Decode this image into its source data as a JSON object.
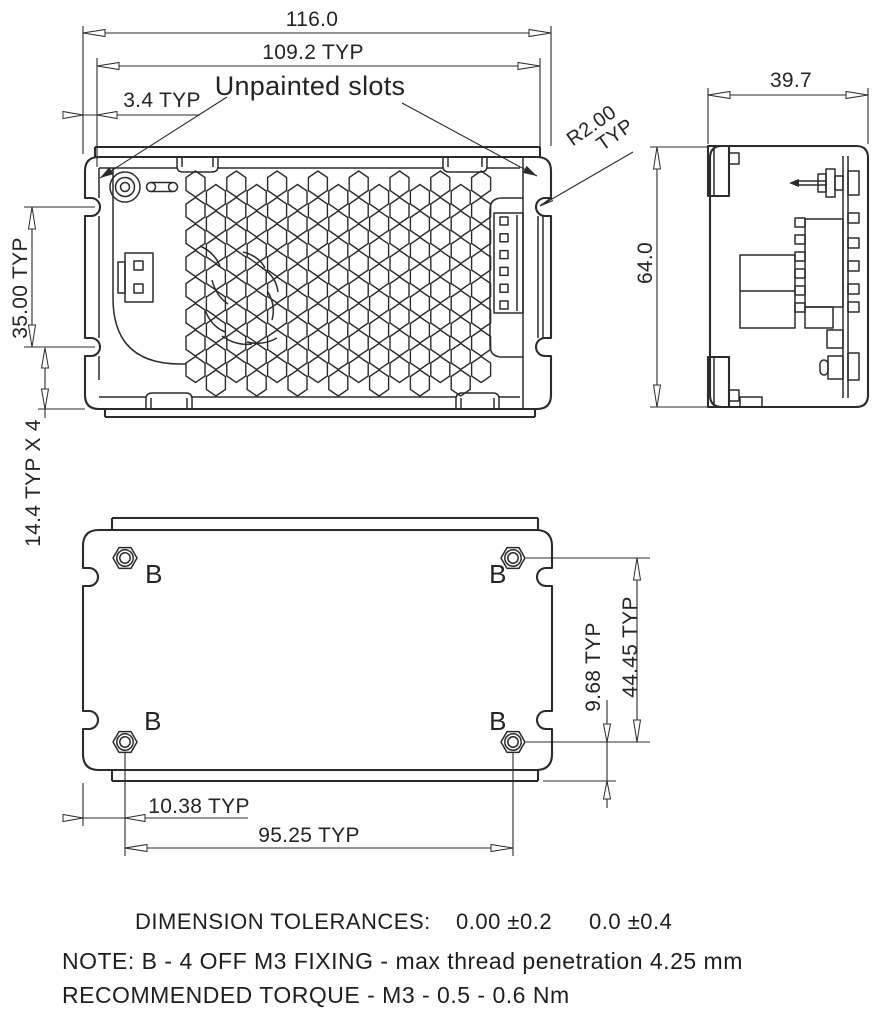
{
  "front_view": {
    "dim_overall_width": "116.0",
    "dim_slot_pitch": "109.2 TYP",
    "dim_slot_offset": "3.4 TYP",
    "dim_slot_vertical_pitch": "35.00 TYP",
    "dim_foot": "14.4 TYP X 4",
    "callout_unpainted": "Unpainted slots",
    "callout_radius": "R2.00",
    "callout_radius_typ": "TYP"
  },
  "side_view": {
    "dim_depth": "39.7",
    "dim_height": "64.0"
  },
  "bottom_view": {
    "fixing_label": "B",
    "dim_hole_edge_vertical": "9.68 TYP",
    "dim_hole_pitch_vertical": "44.45 TYP",
    "dim_hole_edge_horizontal": "10.38 TYP",
    "dim_hole_pitch_horizontal": "95.25 TYP"
  },
  "notes": {
    "tolerances_title": "DIMENSION TOLERANCES:",
    "tolerance_1": "0.00 ±0.2",
    "tolerance_2": "0.0 ±0.4",
    "fixing_note": "NOTE: B - 4 OFF M3 FIXING - max thread penetration 4.25 mm",
    "torque_note": "RECOMMENDED TORQUE - M3 - 0.5 - 0.6 Nm"
  },
  "colors": {
    "line": "#2b2b2b",
    "background": "#ffffff"
  }
}
